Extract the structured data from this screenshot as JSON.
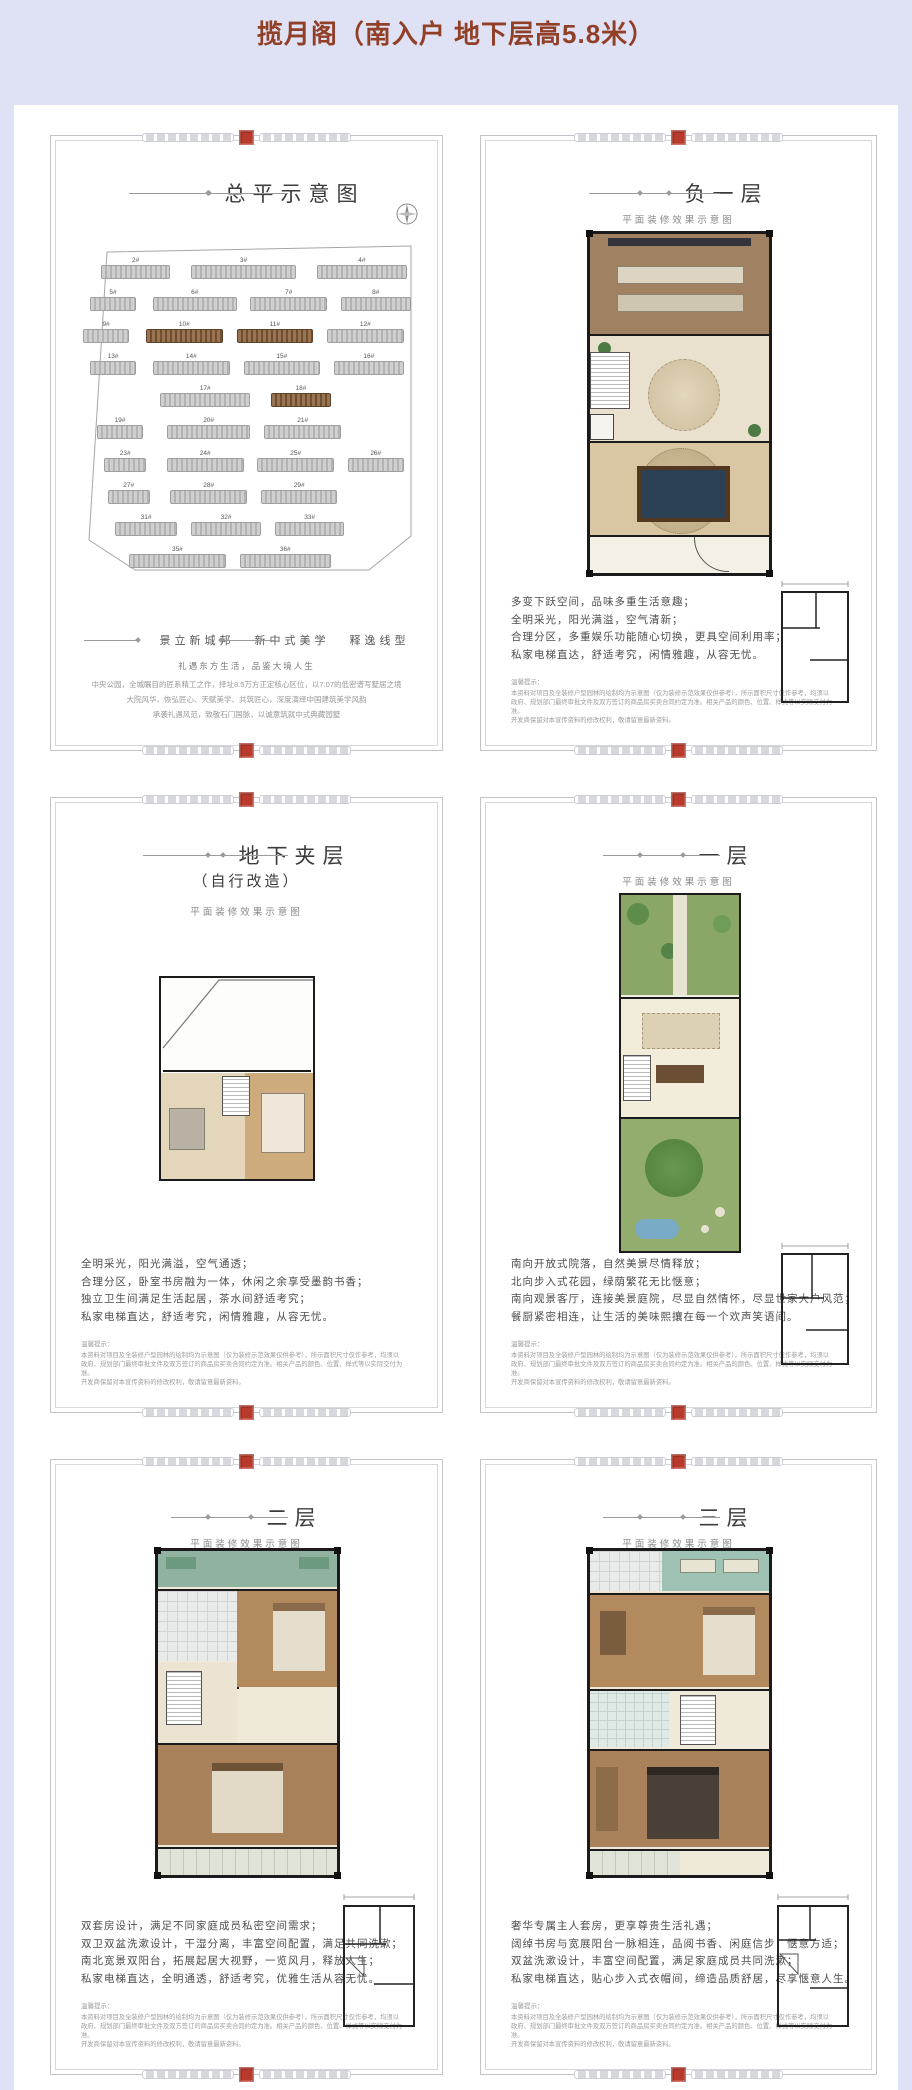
{
  "page": {
    "title": "揽月阁（南入户 地下层高5.8米）",
    "accent_color": "#913f27",
    "background_color": "#dfe2f4",
    "seal_color": "#b93a2c"
  },
  "shared": {
    "subtitle": "平面装修效果示意图",
    "disclaimer_title": "温馨提示：",
    "disclaimer": [
      "本资料对项目及全装修户型园林的绘制均为示意图（仅为装修示范效果仅供参考），所示面积尺寸仅作参考，均须以",
      "政府、规划部门最终审批文件及双方签订的商品房买卖合同约定为准。相关产品的颜色、位置、样式等以实际交付为准。",
      "开发商保留对本宣传资料的修改权利，敬请留意最新资料。"
    ]
  },
  "panels": [
    {
      "title": "总平示意图",
      "slogan": [
        "景立新城邦",
        "新中式美学",
        "释逸线型"
      ],
      "tagline": "礼遇东方生活，品鉴大境人生",
      "intro": [
        "中央公园，全城瞩目的匠系精工之作，择址8.5万方正定核心区位，以7.07的低密谱写墅居之境",
        "大院风华、恢弘匠心、天赋美学、共筑匠心，深度演绎中国建筑美学风韵",
        "承袭礼遇风范，致敬石门国脉，以诚意筑就中式典藏园墅"
      ],
      "buildings": [
        {
          "label": "2#"
        },
        {
          "label": "3#"
        },
        {
          "label": "4#"
        },
        {
          "label": "5#"
        },
        {
          "label": "6#"
        },
        {
          "label": "7#"
        },
        {
          "label": "8#"
        },
        {
          "label": "9#"
        },
        {
          "label": "10#",
          "highlight": true
        },
        {
          "label": "11#",
          "highlight": true
        },
        {
          "label": "12#"
        },
        {
          "label": "13#"
        },
        {
          "label": "14#"
        },
        {
          "label": "15#"
        },
        {
          "label": "16#"
        },
        {
          "label": "17#"
        },
        {
          "label": "18#",
          "highlight": true
        },
        {
          "label": "19#"
        },
        {
          "label": "20#"
        },
        {
          "label": "21#"
        },
        {
          "label": "23#"
        },
        {
          "label": "24#"
        },
        {
          "label": "25#"
        },
        {
          "label": "26#"
        },
        {
          "label": "27#"
        },
        {
          "label": "28#"
        },
        {
          "label": "29#"
        },
        {
          "label": "31#"
        },
        {
          "label": "32#"
        },
        {
          "label": "33#"
        },
        {
          "label": "35#"
        },
        {
          "label": "36#"
        }
      ]
    },
    {
      "title": "负一层",
      "desc": [
        "多变下跃空间，品味多重生活意趣；",
        "全明采光，阳光满溢，空气清新；",
        "合理分区，多重娱乐功能随心切换，更具空间利用率；",
        "私家电梯直达，舒适考究，闲情雅趣，从容无忧。"
      ]
    },
    {
      "title": "地下夹层",
      "title2": "（自行改造）",
      "desc": [
        "全明采光，阳光满溢，空气通透；",
        "合理分区，卧室书房融为一体，休闲之余享受墨韵书香；",
        "独立卫生间满足生活起居，茶水间舒适考究；",
        "私家电梯直达，舒适考究，闲情雅趣，从容无忧。"
      ]
    },
    {
      "title": "一层",
      "desc": [
        "南向开放式院落，自然美景尽情释放；",
        "北向步入式花园，绿荫繁花无比惬意；",
        "南向观景客厅，连接美景庭院，尽显自然情怀，尽显世家大户风范；",
        "餐厨紧密相连，让生活的美味熙攘在每一个欢声笑语间。"
      ]
    },
    {
      "title": "二层",
      "desc": [
        "双套房设计，满足不同家庭成员私密空间需求；",
        "双卫双盆洗漱设计，干湿分离，丰富空间配置，满足共同洗漱；",
        "南北宽景双阳台，拓展起居大视野，一览风月，释放人生；",
        "私家电梯直达，全明通透，舒适考究，优雅生活从容无忧。"
      ]
    },
    {
      "title": "三层",
      "desc": [
        "奢华专属主人套房，更享尊贵生活礼遇；",
        "阔绰书房与宽展阳台一脉相连，品阅书香、闲庭信步，惬意方适；",
        "双盆洗漱设计，丰富空间配置，满足家庭成员共同洗漱；",
        "私家电梯直达，贴心步入式衣帽间，缔造品质舒居，尽享惬意人生。"
      ]
    }
  ]
}
